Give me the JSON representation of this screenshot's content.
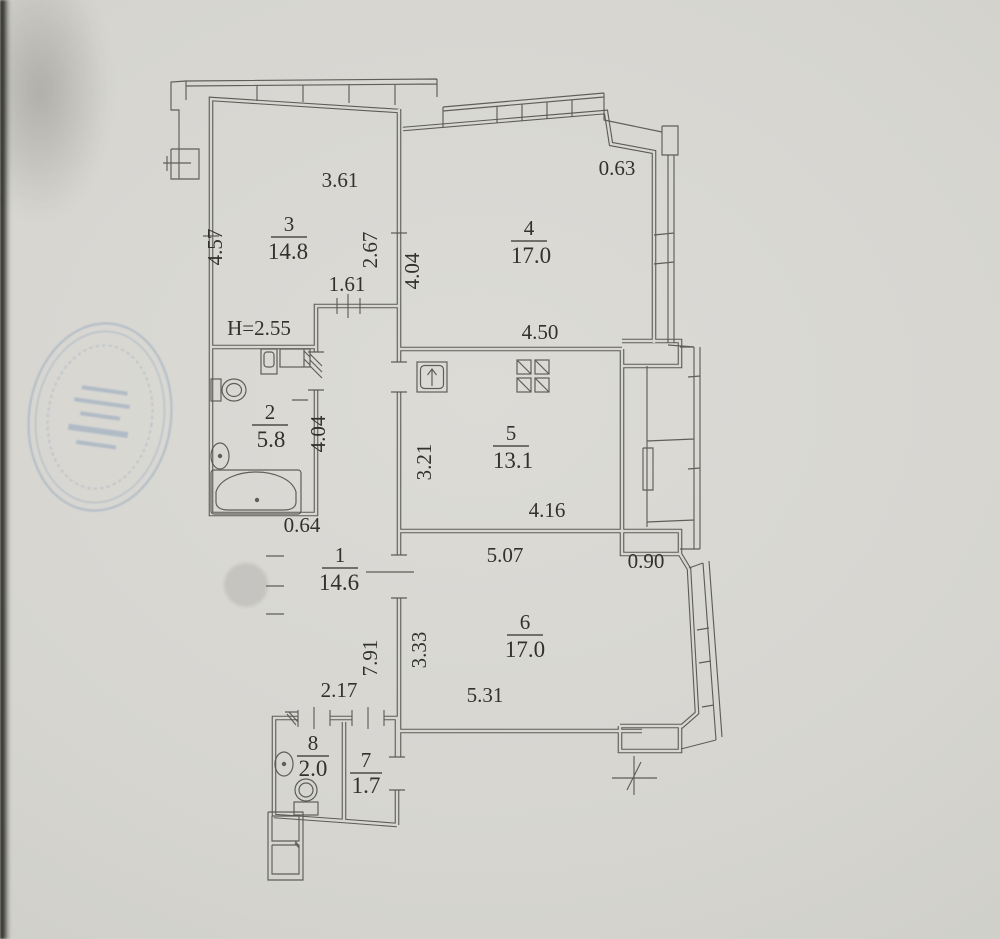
{
  "plan": {
    "type": "apartment-floor-plan",
    "height_note": "H=2.55",
    "rooms": [
      {
        "number": "1",
        "area": "14.6"
      },
      {
        "number": "2",
        "area": "5.8"
      },
      {
        "number": "3",
        "area": "14.8"
      },
      {
        "number": "4",
        "area": "17.0"
      },
      {
        "number": "5",
        "area": "13.1"
      },
      {
        "number": "6",
        "area": "17.0"
      },
      {
        "number": "7",
        "area": "1.7"
      },
      {
        "number": "8",
        "area": "2.0"
      }
    ],
    "dims": {
      "room3_width": "3.61",
      "room3_height": "4.57",
      "room3_right": "2.67",
      "corridor_width": "1.61",
      "room4_corner": "0.63",
      "room4_height": "4.04",
      "room4_width": "4.50",
      "hall_upper_height": "4.04",
      "room5_height": "3.21",
      "hall_step": "0.64",
      "room5_width": "4.16",
      "room6_width_top": "5.07",
      "room6_step": "0.90",
      "hall_height": "7.91",
      "room6_height": "3.33",
      "hall_width": "2.17",
      "room6_width_bottom": "5.31"
    },
    "fixtures": [
      "bathtub",
      "toilet",
      "washbasin",
      "washing-machine",
      "kitchen-sink",
      "stove",
      "toilet",
      "washbasin",
      "ventilation-shaft",
      "level-mark"
    ],
    "colors": {
      "paper": "#d7d6d1",
      "line": "#55544e",
      "text": "#32312c",
      "stamp": "#7d96b6"
    }
  }
}
